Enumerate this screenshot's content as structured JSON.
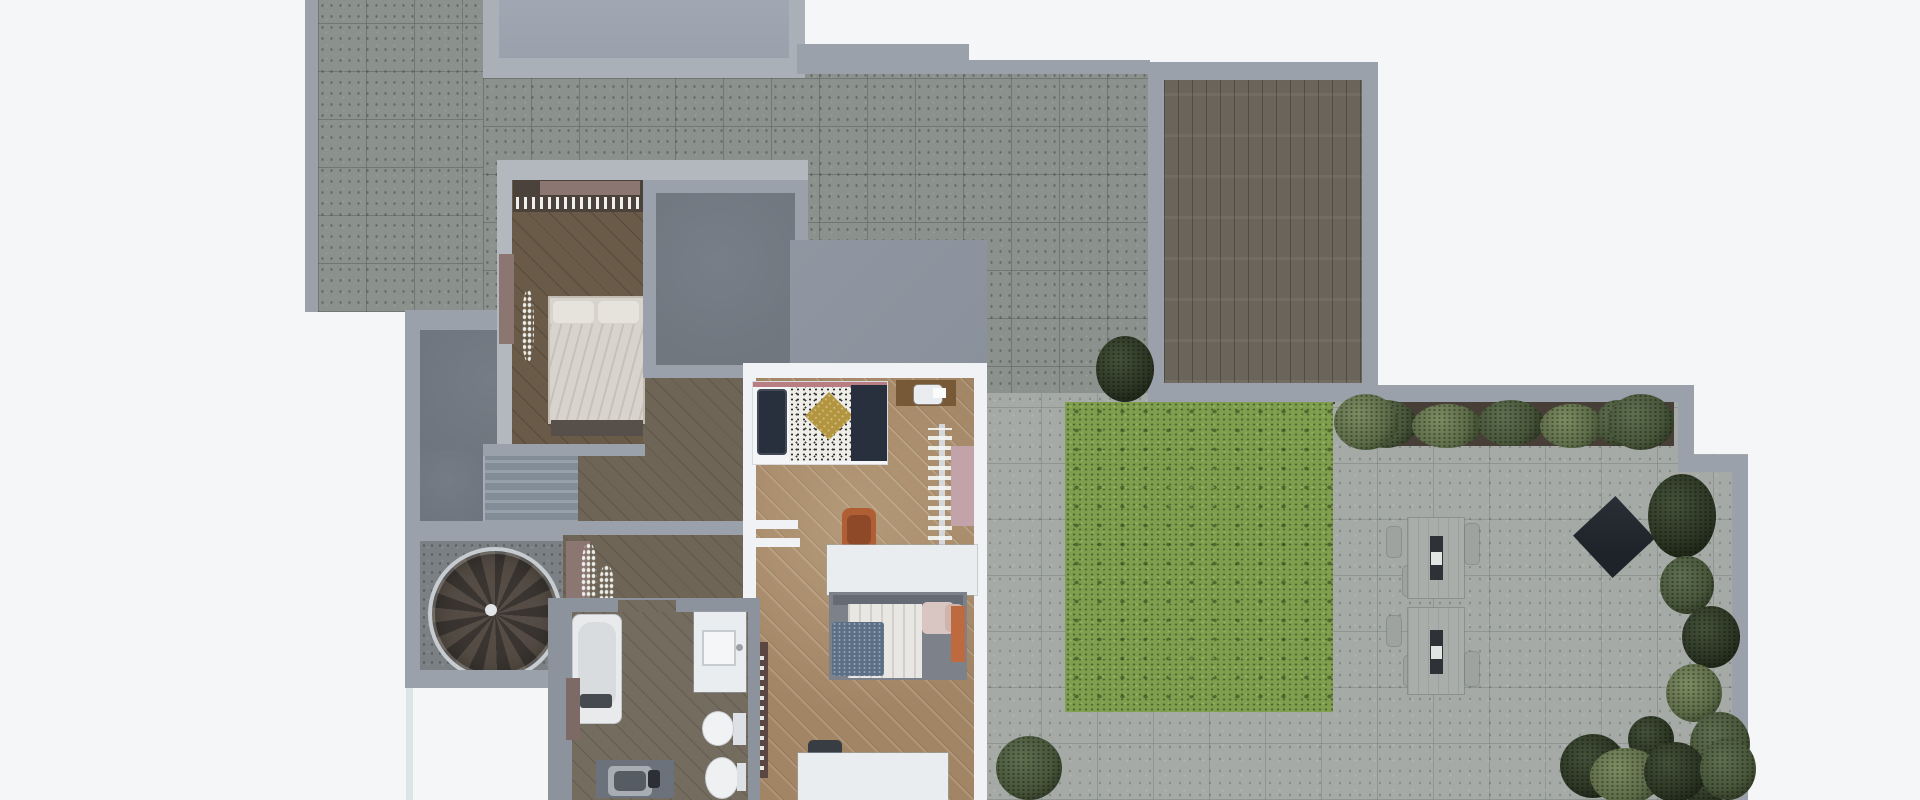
{
  "scene": {
    "kind": "3d-floor-plan-top-down-render",
    "visible_text": "none",
    "description_of_pixels": "Overhead render of an apartment level: speckled-tile terraces, flat roof panels, timber deck, lawn with paved patio and outdoor dining sets, dim bedroom, dark roofed room, brightly lit bedroom with two beds, bathroom, straight and spiral staircases, hedges and bushes along the right edge"
  },
  "palette": {
    "bg": "#f5f6f8",
    "wall-light": "#b3b8bf",
    "wall-mid": "#9aa1ab",
    "wall-dim": "#8d939d",
    "roof-frame": "#aab0b8",
    "roof-inner": "#9aa1ac",
    "tile-dark": "#8b918d",
    "tile-light": "#a6aaa7",
    "concrete-dark": "#6f757e",
    "concrete-spiral": "#7b8084",
    "dark-room": "#71777f",
    "bright-roof": "#8a919c",
    "deck-wood": "#6b645b",
    "wood-dim": "#6a5a48",
    "wood-hall": "#6f6557",
    "wood-bath": "#756c60",
    "wood-bright": "#a28565",
    "white-wall": "#f0f2f5",
    "white-furniture": "#eaedf0",
    "grass": "#7f9f4f",
    "planter-brown": "#473f37",
    "bush-dark": "#2c3624",
    "bush-mid": "#48563a",
    "bush-light": "#5e6d49",
    "spiral-dark": "#3a3531",
    "spiral-mid": "#554d45",
    "navy": "#28303e",
    "mustard": "#b4953f",
    "terracotta": "#b05e34",
    "terracotta-dark": "#8e4a28",
    "pink-rug": "#c2a3a9",
    "orange-throw": "#bf6a3e",
    "blue-blanket": "#5b7086",
    "mauve": "#8b7671",
    "mauve-dark": "#7d6a66",
    "shelf-maroon": "#5c4642",
    "duvet": "#d8d4cd",
    "pillow": "#e6e3dd",
    "bed-frame": "#c2bcb2",
    "footboard": "#57504a",
    "closet-dark": "#4b433b",
    "headboard-pink": "#b97e83",
    "bed2-frame": "#7d828a",
    "headboard-gray": "#666c76",
    "pillow-pink": "#d9c6c3",
    "pillow-blush": "#cfb4ae",
    "desk-wood": "#775837",
    "rail-light": "#d4d8dc",
    "rail-dark": "#3e434a",
    "chair-dark": "#383d44",
    "fixture-dark": "#454a50",
    "mat-gray": "#6b727b",
    "runner-dark": "#2e3236",
    "parasol": "#1e232a",
    "glass": "#d6e0e4",
    "lawn-edge": "#4a4236"
  },
  "areas": [
    {
      "name": "terrace-upper-left",
      "surface": "speckled concrete tiles"
    },
    {
      "name": "rooftop-panel",
      "surface": "smooth roof"
    },
    {
      "name": "upper-terrace",
      "surface": "speckled concrete tiles"
    },
    {
      "name": "timber-deck",
      "surface": "gray wood planks"
    },
    {
      "name": "stair-hall",
      "surface": "dark concrete"
    },
    {
      "name": "straight-staircase",
      "surface": "stone steps"
    },
    {
      "name": "spiral-stair-room",
      "surface": "speckled concrete"
    },
    {
      "name": "hallway",
      "surface": "dim wood"
    },
    {
      "name": "vestibule",
      "surface": "dim wood"
    },
    {
      "name": "bedroom-dim",
      "surface": "dark wood"
    },
    {
      "name": "dark-roofed-room",
      "surface": "flat gray"
    },
    {
      "name": "bright-bedroom-roof",
      "surface": "flat gray"
    },
    {
      "name": "bright-bedroom",
      "surface": "warm lit wood"
    },
    {
      "name": "bathroom",
      "surface": "gray wood"
    },
    {
      "name": "patio",
      "surface": "light concrete tiles"
    },
    {
      "name": "lawn",
      "surface": "grass"
    },
    {
      "name": "planter-row",
      "surface": "dark planter boxes with shrubs"
    },
    {
      "name": "garden-right-edge",
      "surface": "bushes and hedge"
    }
  ],
  "furniture": [
    "bed-dim-bedroom",
    "closet-rail-with-clothes",
    "wardrobe-box",
    "dresser",
    "coat-stand",
    "single-bed-bright",
    "navy-pillows",
    "speckled-duvet",
    "mustard-cushion",
    "navy-blanket",
    "study-desk",
    "white-chair",
    "clothes-rack",
    "pink-rug",
    "orange-desk-chair",
    "white-desk",
    "double-bed-bright",
    "blue-speckled-blanket",
    "pink-pillows",
    "orange-throw",
    "maroon-bookshelf",
    "wall-shelves",
    "white-dresser",
    "dark-chair",
    "bathtub",
    "vanity-sink",
    "toilet",
    "bidet",
    "laundry-basin",
    "bath-cabinet",
    "outdoor-dining-set-1",
    "outdoor-dining-set-2",
    "dark-parasol",
    "planter-shrubs",
    "round-trees",
    "pampas-grass-plants",
    "garden-bushes"
  ]
}
